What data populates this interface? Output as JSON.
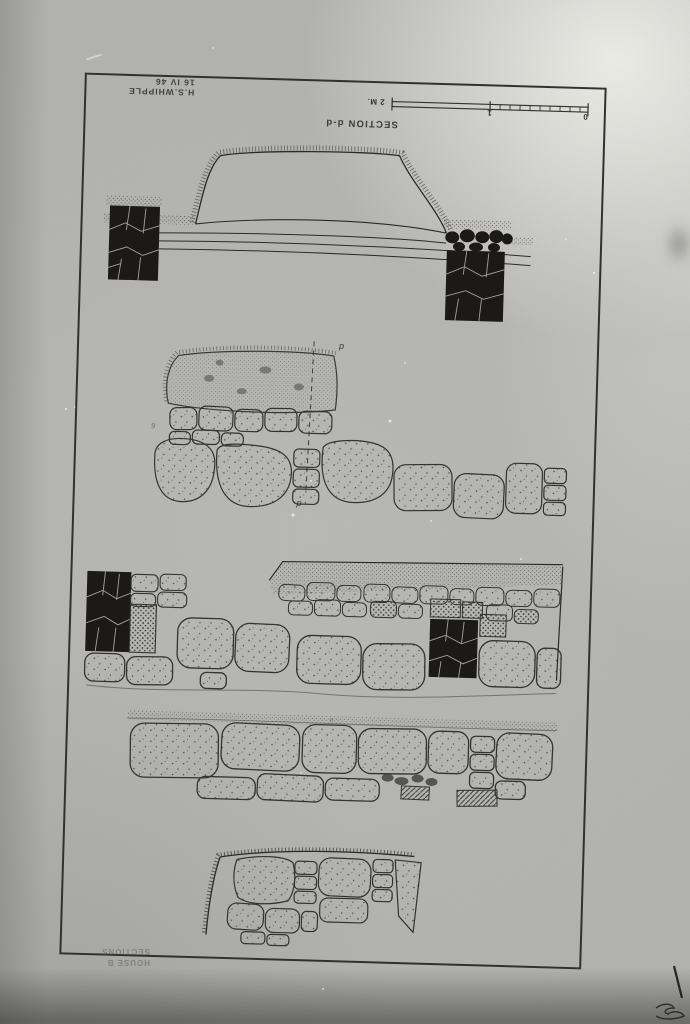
{
  "plate": {
    "signature": {
      "name": "H.S.WHIPPLE",
      "date": "16 IV 46"
    },
    "title": "SECTION d-d",
    "scale_bar": {
      "label_left": "2 M.",
      "label_middle": "1",
      "label_right": "0"
    },
    "annotations": {
      "section_line_top": "d",
      "section_line_bottom": "d",
      "small_mark": "d",
      "pencil_number": "6"
    },
    "caption": {
      "line1": "HOUSE B",
      "line2": "SECTIONS"
    }
  },
  "colors": {
    "photo_background": "#b4b4b1",
    "photo_highlight": "#dddbd6",
    "ink": "#2b2a26",
    "black_fill": "#1b1a17",
    "joint_line": "#a6a29a"
  }
}
